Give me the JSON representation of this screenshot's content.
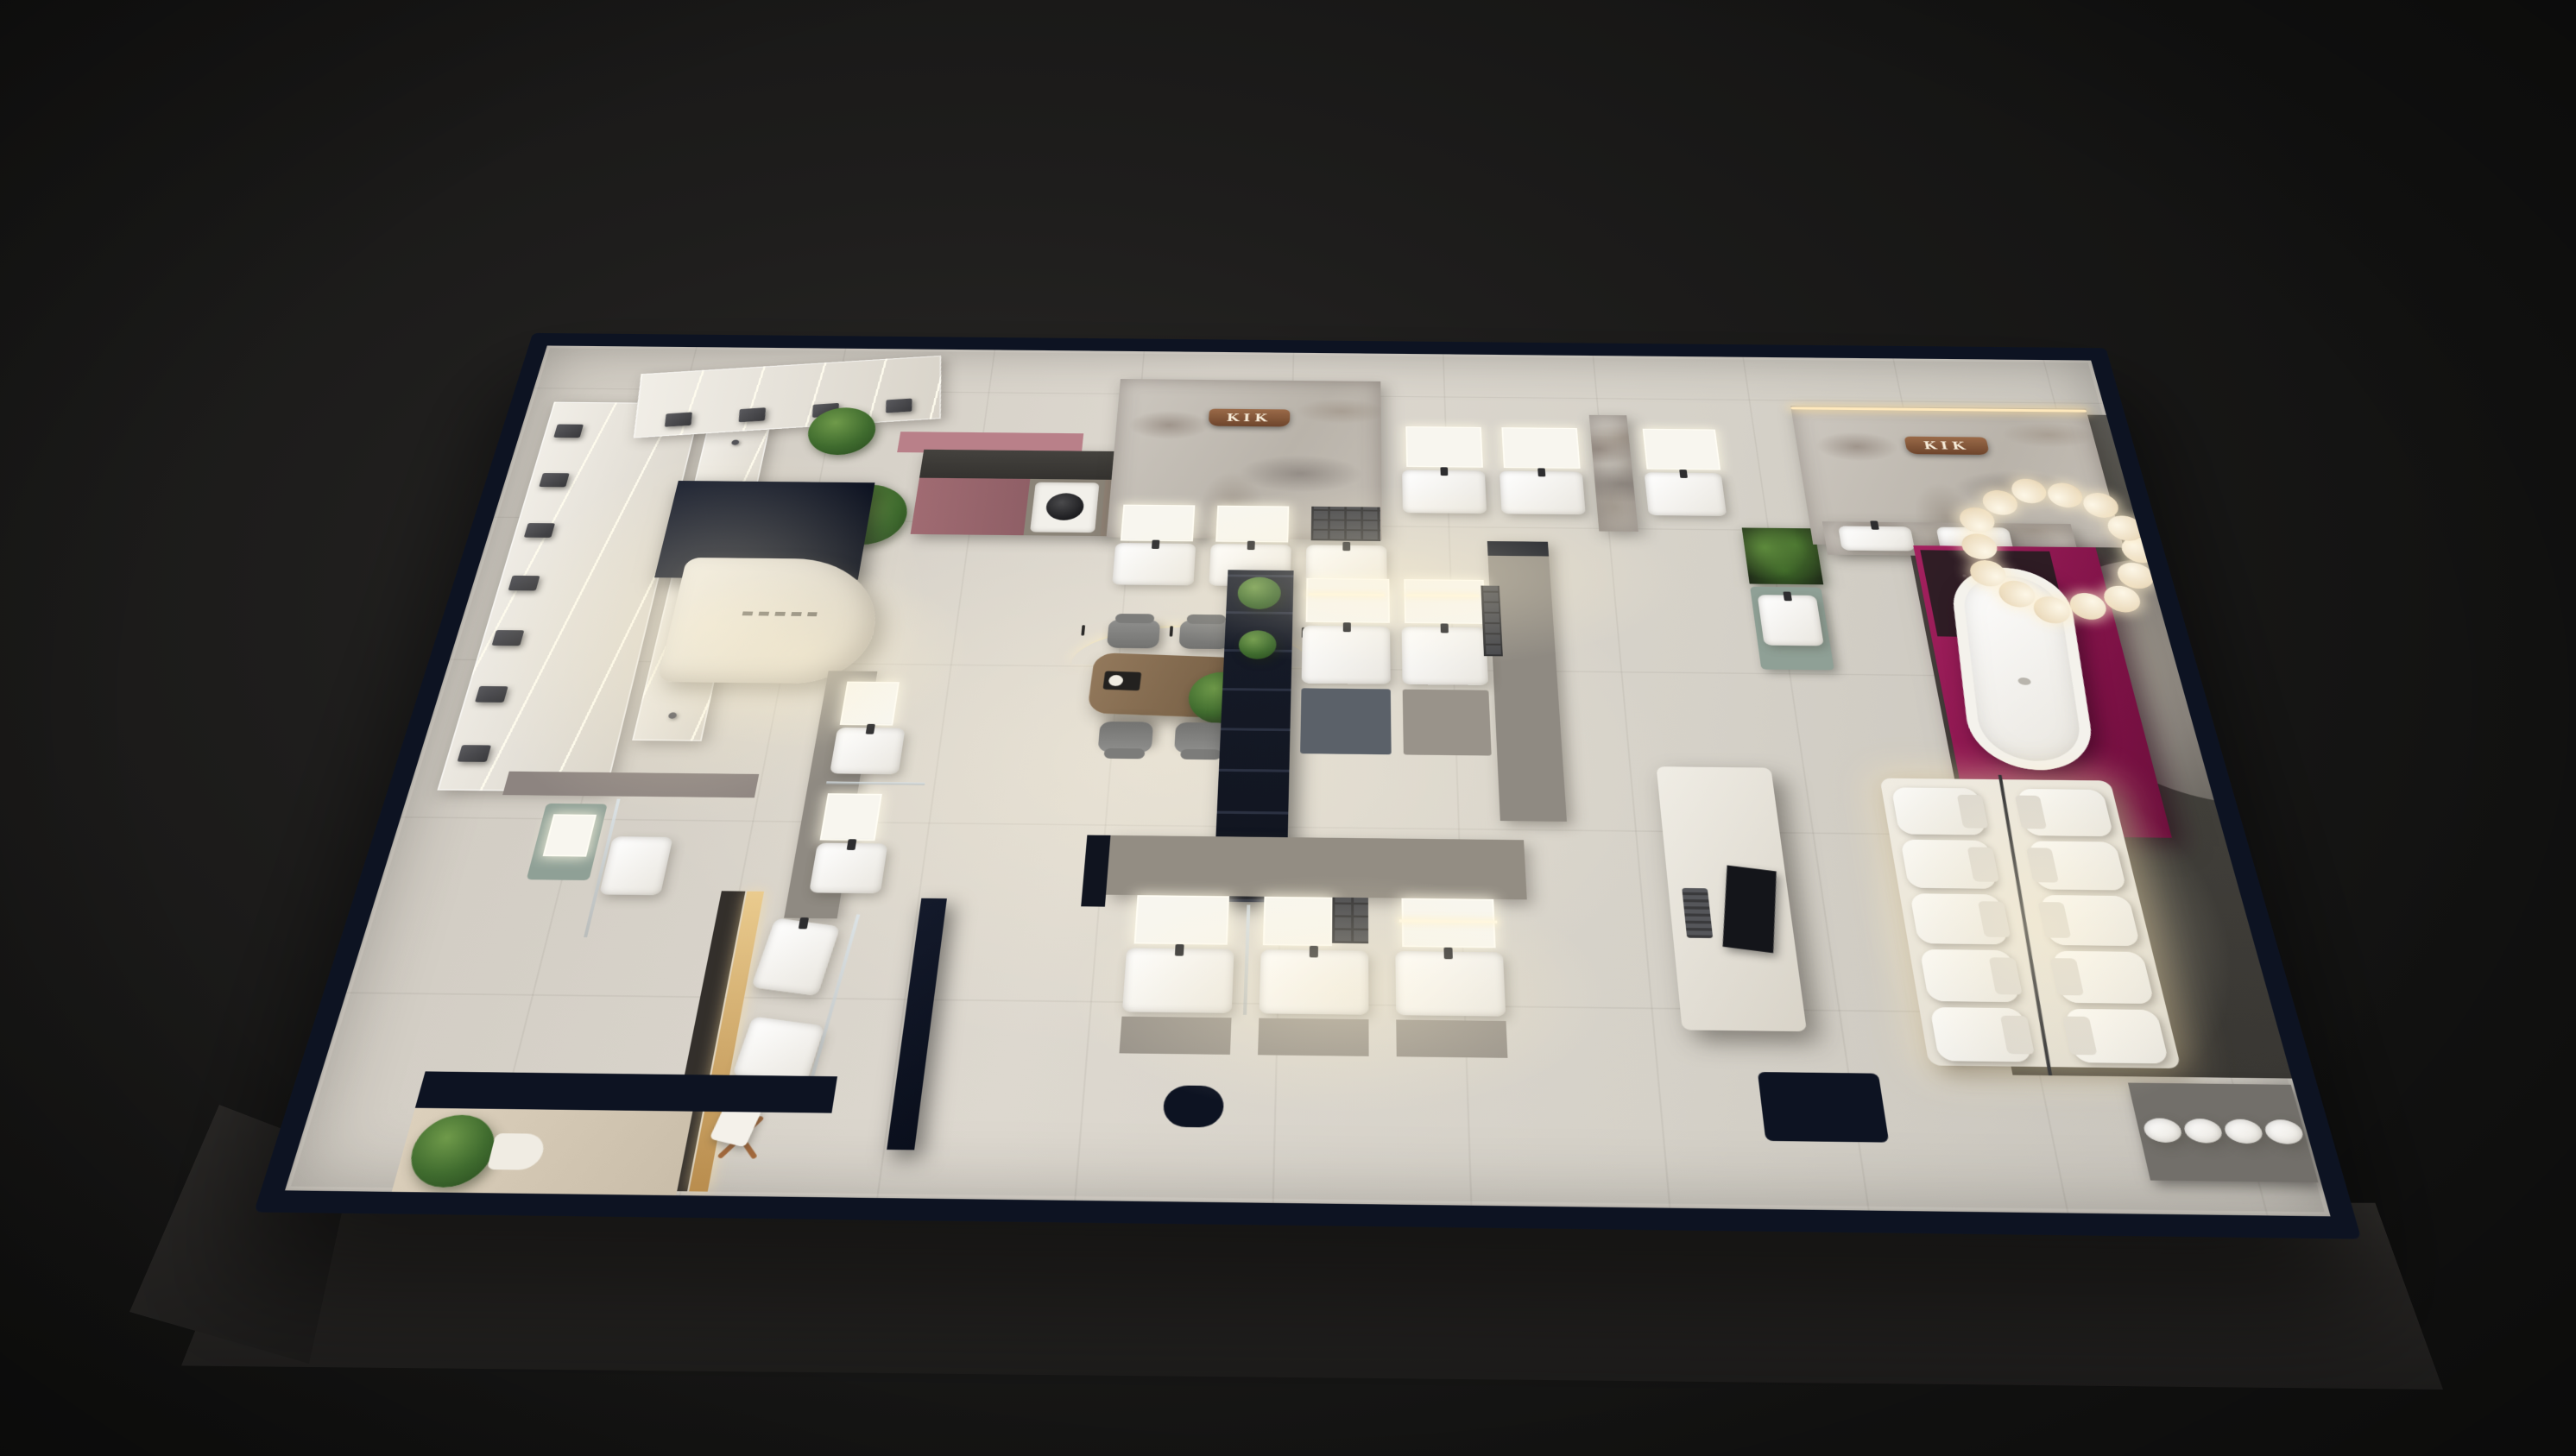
{
  "scene": {
    "title": "Bathroom fixtures showroom — top-down 3D render",
    "setting": "night interior visualization on dark backdrop",
    "signs": [
      {
        "text": "KIK",
        "location": "copper sign on center marble feature wall"
      },
      {
        "text": "KIK",
        "location": "copper sign on right marble feature wall"
      }
    ],
    "palette": {
      "backdrop": "#1e1d1c",
      "floor_tile": "#d5d1c8",
      "wall_cap_navy": "#0d1322",
      "marble": "#c0bab1",
      "magenta_accent": "#8e1850",
      "copper_sign": "#7e5236",
      "led_warm": "#ffe9bd",
      "plant_green": "#3f6b2e",
      "wood_table": "#7d654a",
      "sage_cabinet": "#8fa096",
      "corridor_gray": "#47453f"
    },
    "zones": [
      {
        "id": "shower-display-wall",
        "label": "shower fixture display wall with LED panels"
      },
      {
        "id": "reception-desk",
        "label": "curved reception desk with printed lettering"
      },
      {
        "id": "laundry-demo",
        "label": "laundry counter with washing machine and pink cabinets"
      },
      {
        "id": "marble-wall-center",
        "label": "marble feature wall with KIK sign and vanity units"
      },
      {
        "id": "top-vanity-row",
        "label": "vanity displays along top wall"
      },
      {
        "id": "marble-wall-right",
        "label": "marble feature wall with KIK sign and double-basin vanity"
      },
      {
        "id": "bathtub-stage",
        "label": "freestanding bathtub on magenta platform under bubble chandelier"
      },
      {
        "id": "arch-niche",
        "label": "curved arch niche in dark corridor"
      },
      {
        "id": "consultation-table",
        "label": "wooden consultation table with four chairs and arc pendant light"
      },
      {
        "id": "island-vanities",
        "label": "back-to-back island vanity displays"
      },
      {
        "id": "green-wall",
        "label": "living plant wall with sage vanity"
      },
      {
        "id": "vanity-row-south",
        "label": "row of three lit-mirror vanities"
      },
      {
        "id": "toilet-platform",
        "label": "illuminated platform with ten display toilets"
      },
      {
        "id": "smart-unit",
        "label": "freestanding smart-toilet demo unit with screen"
      },
      {
        "id": "mirror-corridor",
        "label": "left corridor vanity mockups"
      },
      {
        "id": "corner-bathroom",
        "label": "corner bathroom mockup with towel ladder and glass screen"
      },
      {
        "id": "entry-zone",
        "label": "entrance with planting"
      },
      {
        "id": "vessel-basin-counter",
        "label": "vessel basin counter by rear arch"
      }
    ],
    "fixtures": {
      "shower_panels": 14,
      "vanity_units": 14,
      "toilets": 10,
      "bathtubs": 1,
      "washing_machines": 1,
      "dining_chairs": 4,
      "chandelier_globes": 14,
      "plants": 8
    }
  }
}
